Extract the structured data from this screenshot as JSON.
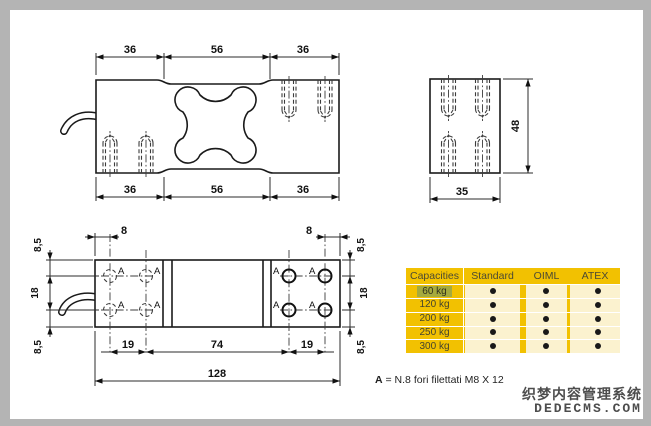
{
  "page": {
    "bg": "#ffffff",
    "frame_color": "#b4b4b4",
    "line_color": "#1a1a1a"
  },
  "views": {
    "top_view": {
      "dims_top": [
        "36",
        "56",
        "36"
      ],
      "dims_bottom": [
        "36",
        "56",
        "36"
      ]
    },
    "end_view": {
      "height_dim": "48",
      "width_dim": "35"
    },
    "bottom_view": {
      "dims_top": [
        "8",
        "8"
      ],
      "dims_left": [
        "8,5",
        "18",
        "8,5"
      ],
      "dims_right": [
        "8,5",
        "18",
        "8,5"
      ],
      "dims_bottom": [
        "19",
        "74",
        "19"
      ],
      "overall_dim": "128",
      "hole_label": "A"
    }
  },
  "note": {
    "bold": "A",
    "text": " = N.8 fori filettati M8 X 12"
  },
  "table": {
    "columns": [
      "Capacities",
      "Standard",
      "OIML",
      "ATEX"
    ],
    "rows": [
      {
        "capacity": "60 kg",
        "standard": true,
        "oiml": true,
        "atex": true,
        "highlighted": true
      },
      {
        "capacity": "120 kg",
        "standard": true,
        "oiml": true,
        "atex": true,
        "highlighted": false
      },
      {
        "capacity": "200 kg",
        "standard": true,
        "oiml": true,
        "atex": true,
        "highlighted": false
      },
      {
        "capacity": "250 kg",
        "standard": true,
        "oiml": true,
        "atex": true,
        "highlighted": false
      },
      {
        "capacity": "300 kg",
        "standard": true,
        "oiml": true,
        "atex": true,
        "highlighted": false
      }
    ],
    "colors": {
      "gold": "#f2c101",
      "stripe": "#fbf2cf",
      "highlight": "#a5aa3e",
      "grid": "#ffffff",
      "dot": "#191919"
    }
  },
  "watermark": {
    "line1": "织梦内容管理系统",
    "line2": "DEDECMS.COM"
  }
}
